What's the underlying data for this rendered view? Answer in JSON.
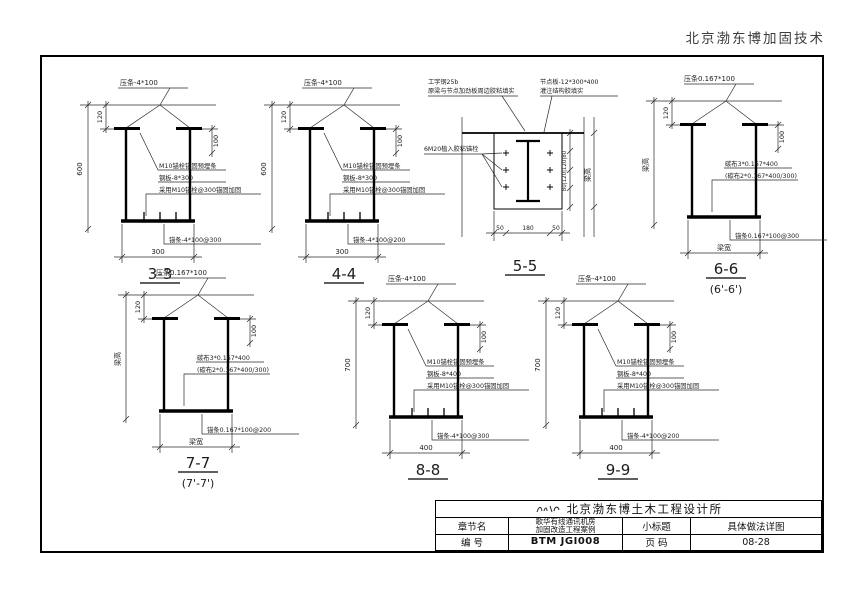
{
  "header": {
    "brand": "北京渤东博加固技术"
  },
  "titleblock": {
    "firm": "北京渤东博土木工程设计所",
    "label_chapter": "章节名",
    "project_line1": "歌华有线通讯机房",
    "project_line2": "加固改造工程案例",
    "label_subtitle": "小标题",
    "subtitle": "具体做法详图",
    "label_number": "编  号",
    "number": "BTM JGI008",
    "label_page": "页  码",
    "page": "08-28",
    "logo_icon": "signature-scribble"
  },
  "sections": {
    "s33": {
      "title": "3-3",
      "top_label": "压条-4*100",
      "dim_height": "600",
      "dim_120": "120",
      "dim_100": "100",
      "dim_width": "300",
      "note1": "M10锚栓锚固预埋条",
      "note2": "钢板-8*300",
      "note3": "采用M10锚栓@300锚固加固",
      "bottom_label": "锚条-4*100@300"
    },
    "s44": {
      "title": "4-4",
      "top_label": "压条-4*100",
      "dim_height": "600",
      "dim_120": "120",
      "dim_100": "100",
      "dim_width": "300",
      "note1": "M10锚栓锚固预埋条",
      "note2": "钢板-8*300",
      "note3": "采用M10锚栓@300锚固加固",
      "bottom_label": "锚条-4*100@200"
    },
    "s55": {
      "title": "5-5",
      "note_tl1": "工字钢25b",
      "note_tl2": "原梁与节点加劲板周边胶粘填实",
      "note_tr1": "节点板-12*300*400",
      "note_tr2": "灌注结构胶填实",
      "note_left": "6M20植入胶粘锚栓",
      "dim_b1": "50",
      "dim_b2": "180",
      "dim_b3": "50",
      "dim_right_chain": "80|120|120|80",
      "dim_right_outer": "梁高"
    },
    "s66": {
      "title": "6-6",
      "subtitle": "(6'-6')",
      "top_label": "压条0.167*100",
      "dim_height": "梁高",
      "dim_120": "120",
      "dim_100": "100",
      "dim_width": "梁宽",
      "note1": "碳布3*0.167*400",
      "note2": "(碳布2*0.167*400/300)",
      "bottom_label": "锚条0.167*100@300"
    },
    "s77": {
      "title": "7-7",
      "subtitle": "(7'-7')",
      "top_label": "压条0.167*100",
      "dim_height": "梁高",
      "dim_120": "120",
      "dim_100": "100",
      "dim_width": "梁宽",
      "note1": "碳布3*0.167*400",
      "note2": "(碳布2*0.167*400/300)",
      "bottom_label": "锚条0.167*100@200"
    },
    "s88": {
      "title": "8-8",
      "top_label": "压条-4*100",
      "dim_height": "700",
      "dim_120": "120",
      "dim_100": "100",
      "dim_width": "400",
      "note1": "M10锚栓锚固预埋条",
      "note2": "钢板-8*400",
      "note3": "采用M10锚栓@300锚固加固",
      "bottom_label": "锚条-4*100@300"
    },
    "s99": {
      "title": "9-9",
      "top_label": "压条-4*100",
      "dim_height": "700",
      "dim_120": "120",
      "dim_100": "100",
      "dim_width": "400",
      "note1": "M10锚栓锚固预埋条",
      "note2": "钢板-8*400",
      "note3": "采用M10锚栓@300锚固加固",
      "bottom_label": "锚条-4*100@200"
    }
  }
}
